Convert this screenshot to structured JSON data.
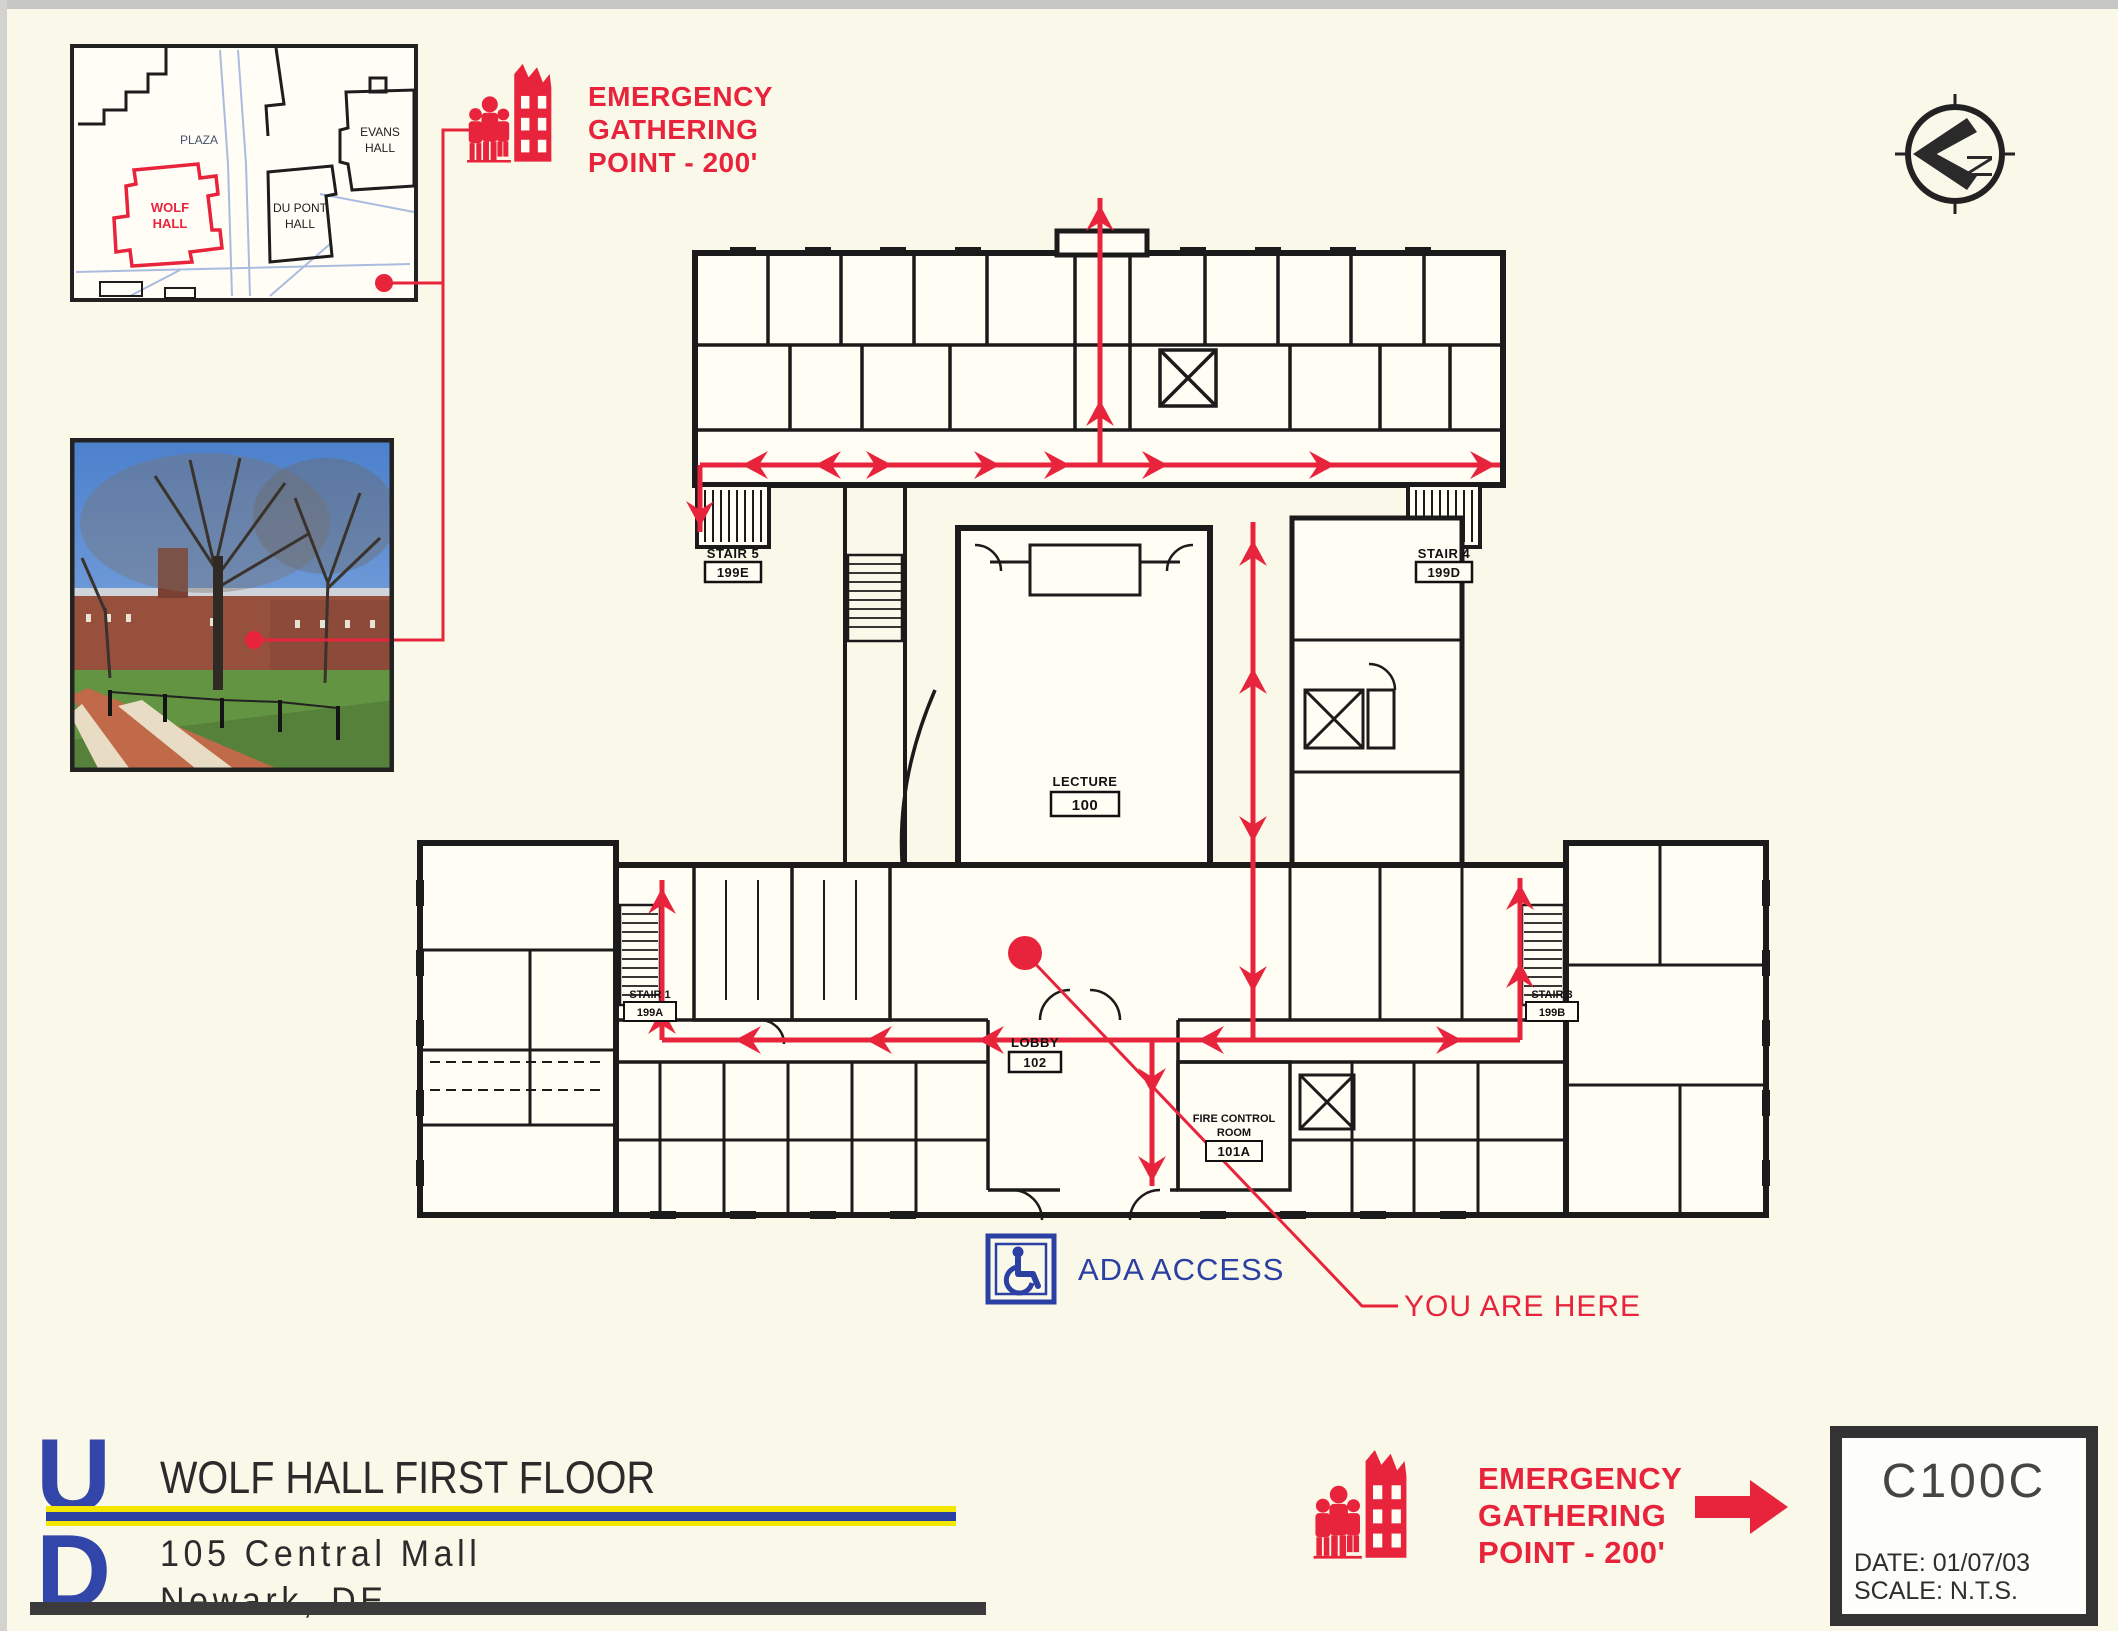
{
  "colors": {
    "red": "#e8243c",
    "blue": "#2c3fa3",
    "wall": "#1b1b1b",
    "yellow": "#f3e600",
    "page_bg": "#faf8e9"
  },
  "campus_inset": {
    "plaza": "PLAZA",
    "wolf_line1": "WOLF",
    "wolf_line2": "HALL",
    "dupont_line1": "DU PONT",
    "dupont_line2": "HALL",
    "evans_line1": "EVANS",
    "evans_line2": "HALL"
  },
  "legend": {
    "line1": "EMERGENCY",
    "line2": "GATHERING",
    "line3": "POINT - 200'"
  },
  "north_arrow": {
    "letter": "N"
  },
  "plan": {
    "lecture_name": "LECTURE",
    "lecture_num": "100",
    "lobby_name": "LOBBY",
    "lobby_num": "102",
    "fire_line1": "FIRE CONTROL",
    "fire_line2": "ROOM",
    "fire_num": "101A",
    "stair5_name": "STAIR 5",
    "stair5_num": "199E",
    "stair4_name": "STAIR 4",
    "stair4_num": "199D",
    "stair1_name": "STAIR 1",
    "stair1_num": "199A",
    "stair3_name": "STAIR 3",
    "stair3_num": "199B",
    "you_are_here": "YOU ARE HERE",
    "ada": "ADA ACCESS"
  },
  "footer": {
    "logo_u": "U",
    "logo_d": "D",
    "building_title": "WOLF HALL FIRST FLOOR",
    "address_line1": "105 Central Mall",
    "address_line2": "Newark, DE"
  },
  "title_block": {
    "sheet_number": "C100C",
    "date_label": "DATE:",
    "date_value": "01/07/03",
    "scale_label": "SCALE:",
    "scale_value": "N.T.S."
  }
}
